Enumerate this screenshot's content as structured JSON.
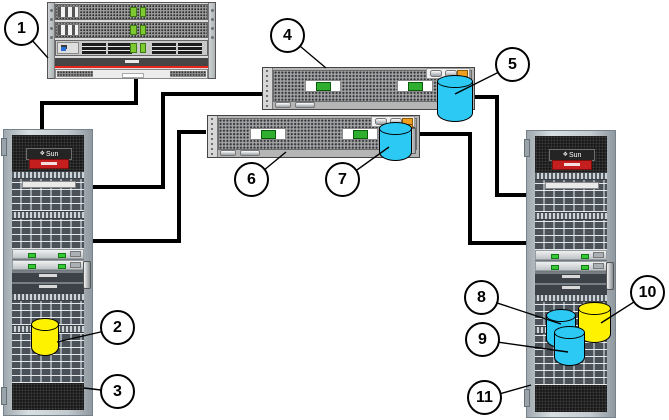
{
  "diagram": {
    "brand": "Sun",
    "icons": {
      "sun_logo": "❖"
    },
    "callouts": [
      "1",
      "2",
      "3",
      "4",
      "5",
      "6",
      "7",
      "8",
      "9",
      "10",
      "11"
    ],
    "colors": {
      "cable": "#000000",
      "cylinder_blue": "#2bc9f4",
      "cylinder_yellow": "#fff200",
      "server_stripe_red": "#e8251d",
      "rack_badge_red": "#c41e1e",
      "led_green": "#37c837",
      "array_label_green": "#2fae2f",
      "corner_chip_orange": "#f0a01e"
    }
  }
}
